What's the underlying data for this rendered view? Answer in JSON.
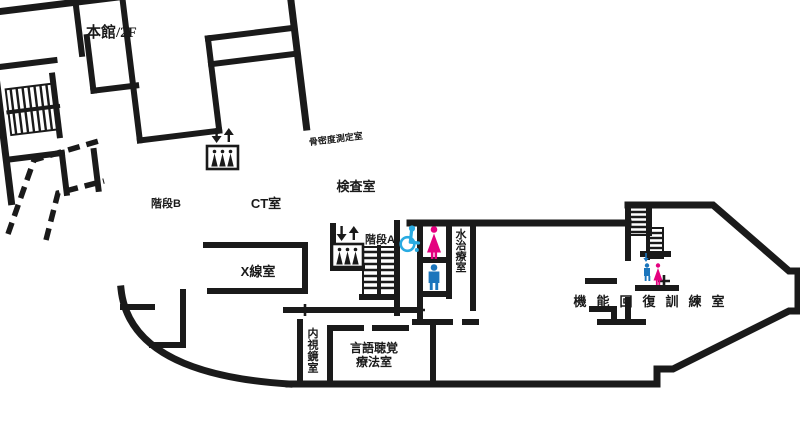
{
  "title": "本館/2F",
  "colors": {
    "wall": "#1a1a1a",
    "female_icon": "#e4007f",
    "male_icon": "#1b75bc",
    "wheelchair_icon": "#29abe2",
    "background": "#ffffff"
  },
  "rooms": {
    "bone_density": {
      "label": "骨密度測定室"
    },
    "examination": {
      "label": "検査室"
    },
    "ct": {
      "label": "CT室"
    },
    "stairs_b": {
      "label": "階段B"
    },
    "xray": {
      "label": "X線室"
    },
    "stairs_a": {
      "label": "階段A"
    },
    "water_therapy": {
      "label": "水治療室"
    },
    "endoscopy": {
      "label": "内視鏡室"
    },
    "speech_therapy": {
      "lines": [
        "言語聴覚",
        "療法室"
      ]
    },
    "rehabilitation": {
      "label": "機能回復訓練室"
    }
  },
  "icons": {
    "elevator_main": "elevator-icon",
    "elevator_a": "elevator-icon",
    "stairs_b": "stairs-icon",
    "stairs_a": "stairs-icon",
    "stairs_right": "stairs-icon",
    "wheelchair": "wheelchair-accessible-icon",
    "toilet_female": "female-toilet-icon",
    "toilet_male": "male-toilet-icon",
    "toilet_female_small": "female-toilet-icon",
    "toilet_male_small": "male-toilet-icon"
  },
  "connector": {
    "style": "dashed",
    "meaning": "connecting-corridor"
  }
}
